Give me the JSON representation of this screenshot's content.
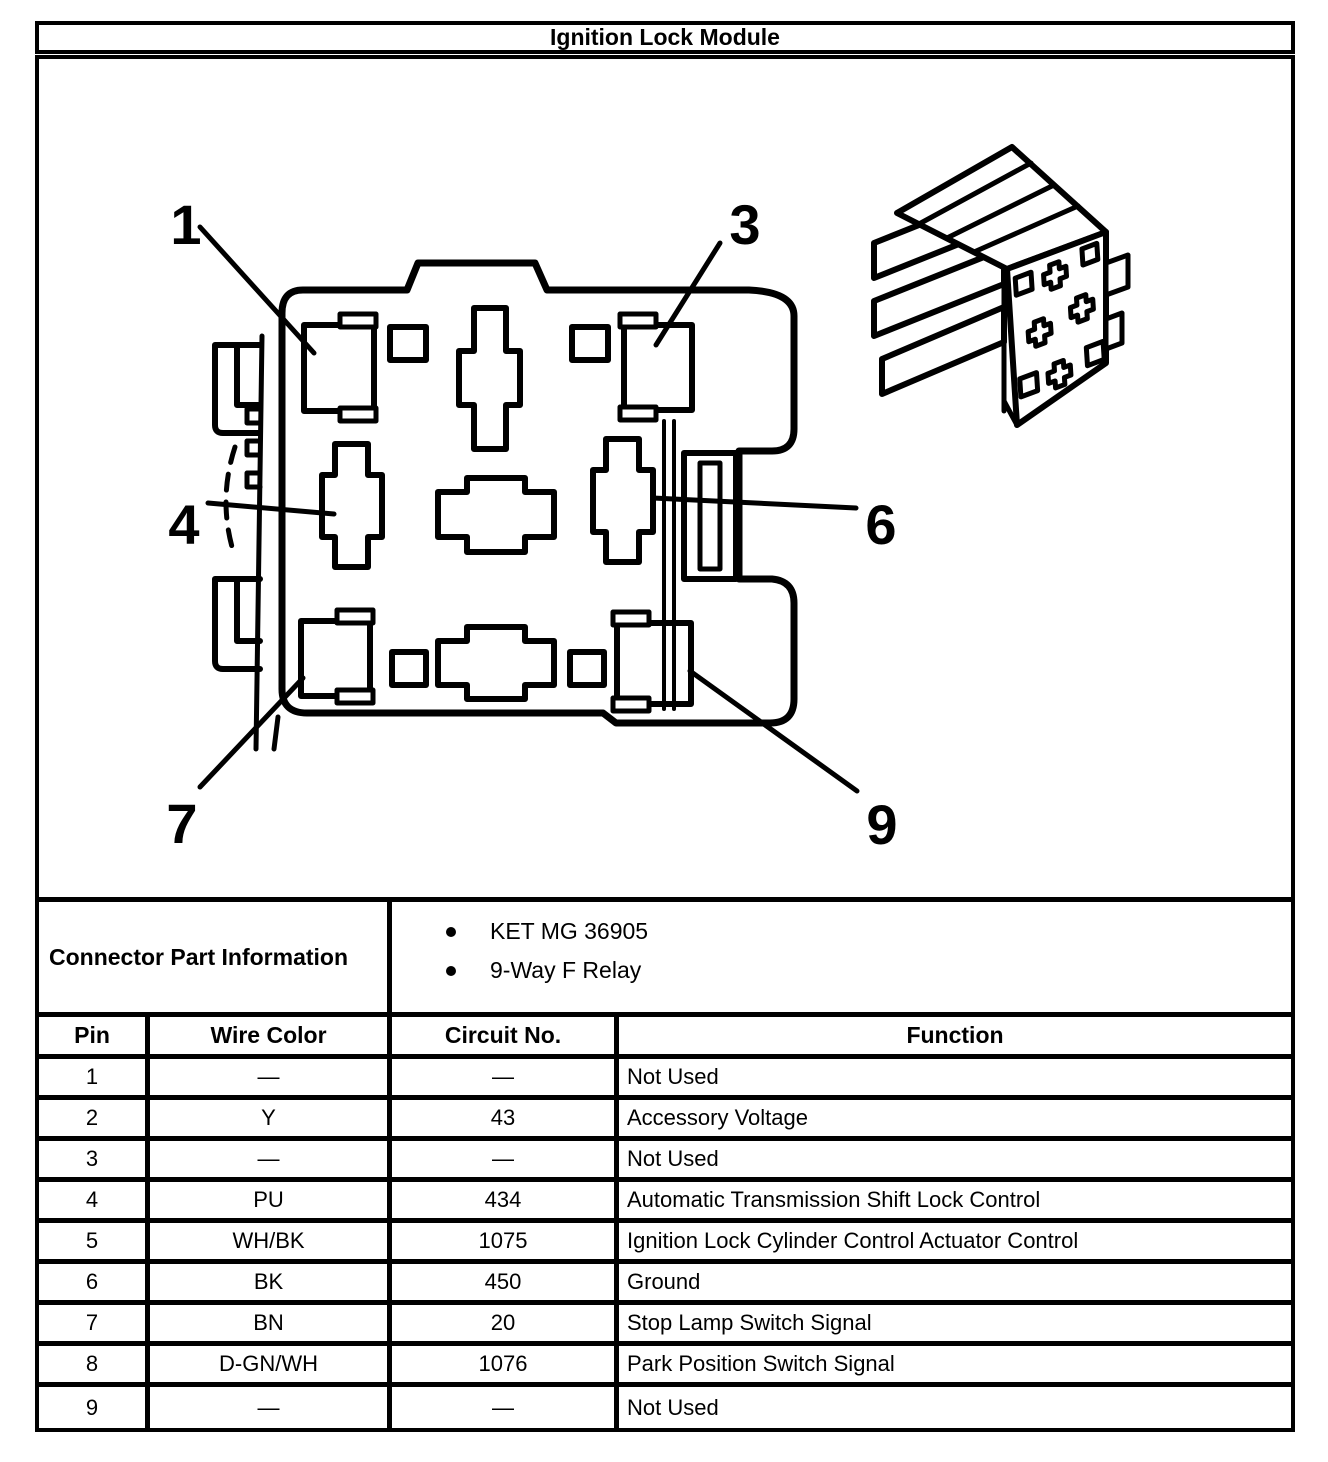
{
  "title": "Ignition Lock Module",
  "part_info": {
    "label": "Connector Part Information",
    "bullets": [
      "KET MG 36905",
      "9-Way F Relay"
    ]
  },
  "table": {
    "headers": [
      "Pin",
      "Wire Color",
      "Circuit No.",
      "Function"
    ],
    "rows": [
      {
        "pin": "1",
        "wire_color": "—",
        "circuit_no": "—",
        "function": "Not Used"
      },
      {
        "pin": "2",
        "wire_color": "Y",
        "circuit_no": "43",
        "function": "Accessory Voltage"
      },
      {
        "pin": "3",
        "wire_color": "—",
        "circuit_no": "—",
        "function": "Not Used"
      },
      {
        "pin": "4",
        "wire_color": "PU",
        "circuit_no": "434",
        "function": "Automatic Transmission Shift Lock Control"
      },
      {
        "pin": "5",
        "wire_color": "WH/BK",
        "circuit_no": "1075",
        "function": "Ignition Lock Cylinder Control Actuator Control"
      },
      {
        "pin": "6",
        "wire_color": "BK",
        "circuit_no": "450",
        "function": "Ground"
      },
      {
        "pin": "7",
        "wire_color": "BN",
        "circuit_no": "20",
        "function": "Stop Lamp Switch Signal"
      },
      {
        "pin": "8",
        "wire_color": "D-GN/WH",
        "circuit_no": "1076",
        "function": "Park Position Switch Signal"
      },
      {
        "pin": "9",
        "wire_color": "—",
        "circuit_no": "—",
        "function": "Not Used"
      }
    ]
  },
  "diagram": {
    "callouts": {
      "c1": "1",
      "c3": "3",
      "c4": "4",
      "c6": "6",
      "c7": "7",
      "c9": "9"
    },
    "colors": {
      "ink": "#000000",
      "paper": "#ffffff"
    }
  }
}
